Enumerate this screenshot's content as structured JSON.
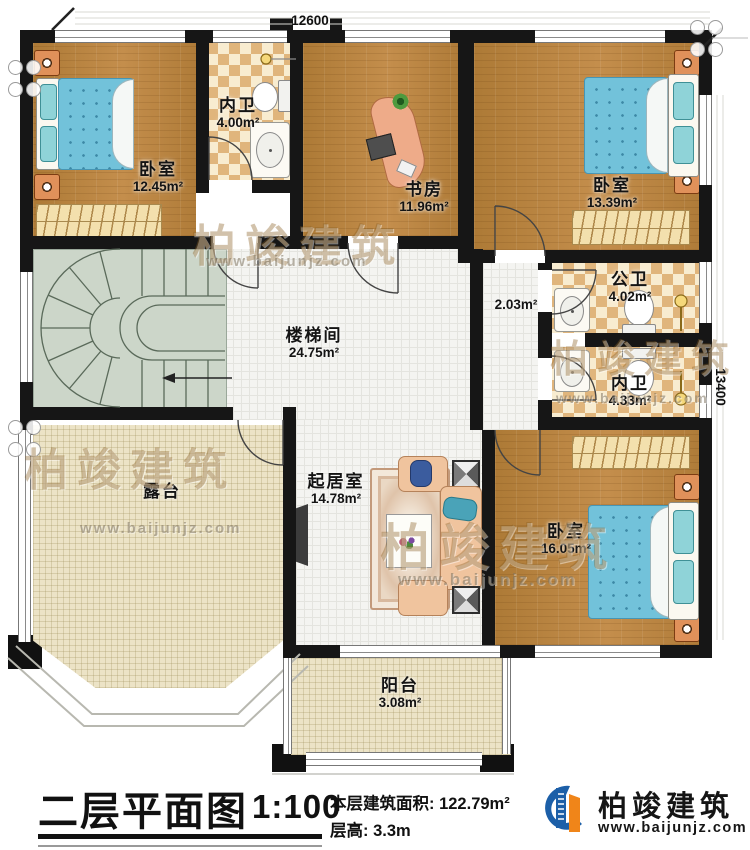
{
  "plan": {
    "dim_top": "12600",
    "dim_right": "13400",
    "rooms": [
      {
        "name": "卧室",
        "area": "12.45m²"
      },
      {
        "name": "内卫",
        "area": "4.00m²"
      },
      {
        "name": "书房",
        "area": "11.96m²"
      },
      {
        "name": "卧室",
        "area": "13.39m²"
      },
      {
        "name": "楼梯间",
        "area": "24.75m²"
      },
      {
        "name": "",
        "area": "2.03m²"
      },
      {
        "name": "公卫",
        "area": "4.02m²"
      },
      {
        "name": "内卫",
        "area": "4.33m²"
      },
      {
        "name": "起居室",
        "area": "14.78m²"
      },
      {
        "name": "卧室",
        "area": "16.05m²"
      },
      {
        "name": "露台",
        "area": ""
      },
      {
        "name": "阳台",
        "area": "3.08m²"
      }
    ],
    "watermark": {
      "brand": "柏竣建筑",
      "url": "www.baijunjz.com"
    }
  },
  "titleblock": {
    "title": "二层平面图",
    "scale": "1:100",
    "area_line": "本层建筑面积: 122.79m²",
    "height_line": "层高: 3.3m"
  },
  "logo": {
    "company": "柏竣建筑",
    "website": "www.baijunjz.com"
  },
  "colors": {
    "wall": "#161616",
    "wood": "#b5813e",
    "tile_blue": "#72c2da",
    "brand_blue": "#1c5fa8",
    "brand_orange": "#f08519"
  }
}
